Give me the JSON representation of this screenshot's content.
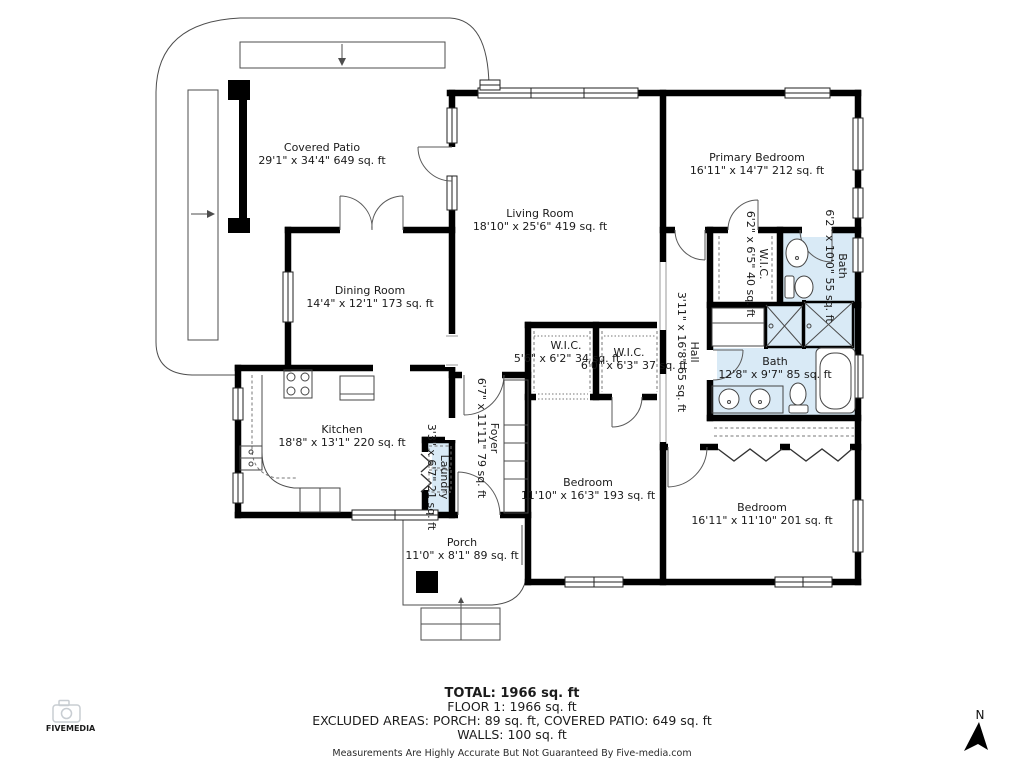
{
  "colors": {
    "bath_fill": "#d9eaf6",
    "wall": "#000000",
    "line": "#4d4d4d",
    "logo_five": "#d93a3e",
    "logo_media": "#474c52",
    "camera": "#c8cdd2"
  },
  "rooms": {
    "covered_patio": {
      "name": "Covered Patio",
      "dims": "29'1\" x 34'4\" 649 sq. ft"
    },
    "living_room": {
      "name": "Living Room",
      "dims": "18'10\" x 25'6\" 419 sq. ft"
    },
    "primary_bedroom": {
      "name": "Primary Bedroom",
      "dims": "16'11\" x 14'7\" 212 sq. ft"
    },
    "dining_room": {
      "name": "Dining Room",
      "dims": "14'4\" x 12'1\" 173 sq. ft"
    },
    "kitchen": {
      "name": "Kitchen",
      "dims": "18'8\" x 13'1\" 220 sq. ft"
    },
    "wic_1": {
      "name": "W.I.C.",
      "dims": "5'6\" x 6'2\" 34 sq. ft"
    },
    "wic_2": {
      "name": "W.I.C.",
      "dims": "6'0\" x 6'3\" 37 sq. ft"
    },
    "wic_primary": {
      "name": "W.I.C.",
      "dims": "6'2\" x 6'5\" 40 sq. ft"
    },
    "hall": {
      "name": "Hall",
      "dims": "3'11\" x 16'8\" 65 sq. ft"
    },
    "bath_primary": {
      "name": "Bath",
      "dims": "6'2\" x 10'0\" 55 sq. ft"
    },
    "bath_main": {
      "name": "Bath",
      "dims": "12'8\" x 9'7\" 85 sq. ft"
    },
    "foyer": {
      "name": "Foyer",
      "dims": "6'7\" x 11'11\" 79 sq. ft"
    },
    "laundry": {
      "name": "Laundry",
      "dims": "3'3\" x 6'7\" 21 sq. ft"
    },
    "bedroom_1": {
      "name": "Bedroom",
      "dims": "11'10\" x 16'3\" 193 sq. ft"
    },
    "bedroom_2": {
      "name": "Bedroom",
      "dims": "16'11\" x 11'10\" 201 sq. ft"
    },
    "porch": {
      "name": "Porch",
      "dims": "11'0\" x 8'1\" 89 sq. ft"
    }
  },
  "footer": {
    "total": "TOTAL: 1966 sq. ft",
    "floor": "FLOOR 1: 1966 sq. ft",
    "excluded": "EXCLUDED AREAS: PORCH: 89 sq. ft, COVERED PATIO: 649 sq. ft",
    "walls": "WALLS: 100 sq. ft",
    "disclaimer": "Measurements Are Highly Accurate But Not Guaranteed By Five-media.com"
  },
  "logo": {
    "five": "FIVE",
    "media": "MEDIA"
  },
  "compass": {
    "label": "N"
  }
}
